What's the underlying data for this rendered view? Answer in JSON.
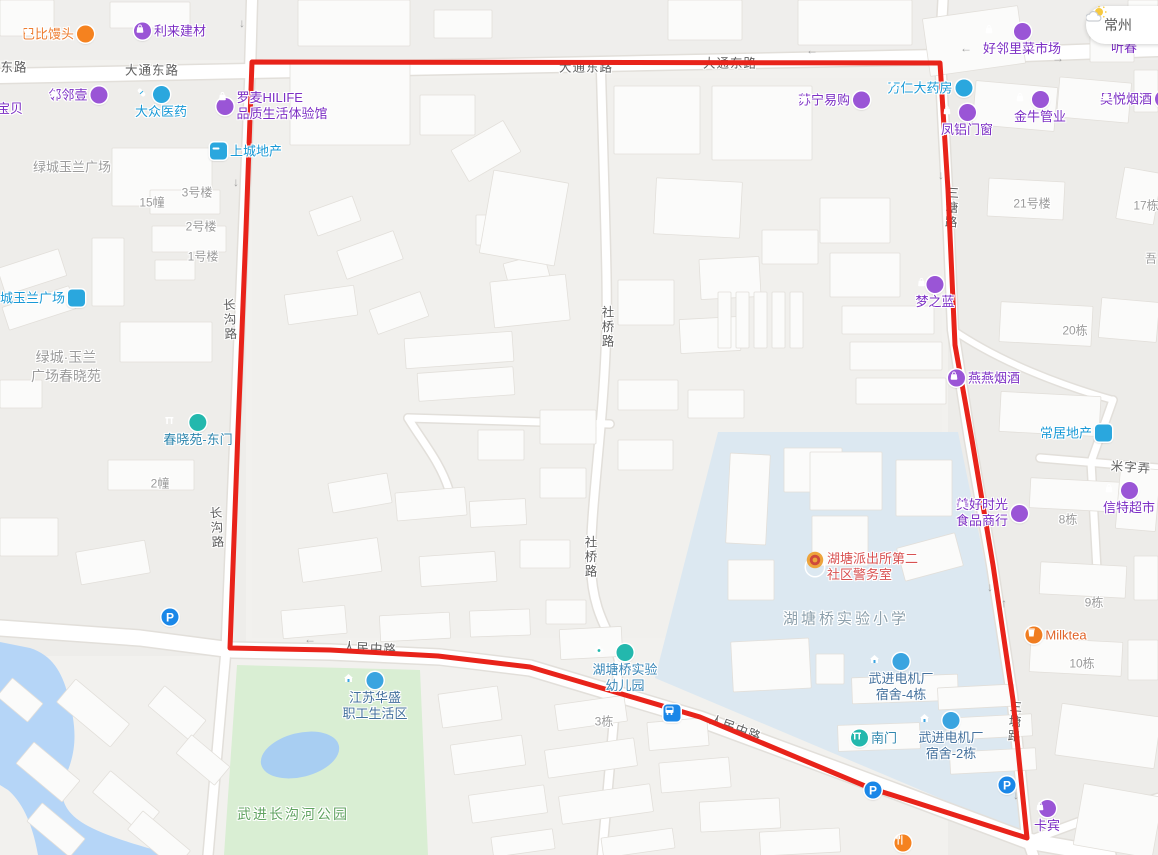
{
  "app": {
    "title": "地图"
  },
  "weather": {
    "city": "常州"
  },
  "colors": {
    "route_red": "#e8231a",
    "poi_purple_text": "#7c2fc4",
    "poi_purple_icon": "#9a55d6",
    "poi_blue_text": "#1899d6",
    "poi_blue_icon": "#2aa7de",
    "teal_icon": "#23b8ad",
    "gate_text": "#2e86ad",
    "residence_text": "#44719d",
    "residence_icon": "#3aa4e0",
    "police_text": "#d85151",
    "badge_gold": "#eda43c",
    "badge_red": "#cf4a3c",
    "orange_icon": "#f5821f",
    "orange_text": "#ed7d31",
    "milktea_text": "#e0642a",
    "parking_blue": "#1a87e8",
    "road_label": "#5e5e5e",
    "building_label": "#9b9b9b",
    "park_fill": "#d9eed3",
    "water_fill": "#b5d5f7",
    "campus_fill": "#dce8f1"
  },
  "types": {
    "shop": {
      "icon": "bag",
      "iconBg": "#9a55d6",
      "text": "#7c2fc4"
    },
    "pharmacy": {
      "icon": "capsule",
      "iconBg": "#2aa7de",
      "text": "#1899d6"
    },
    "estate": {
      "icon": "dash",
      "iconBg": "#2aa7de",
      "text": "#1899d6",
      "square": true
    },
    "gate": {
      "icon": "gate",
      "iconBg": "#23b8ad",
      "text": "#2e86ad"
    },
    "kindergarten": {
      "icon": "flower",
      "iconBg": "#23b8ad",
      "text": "#3a87b7"
    },
    "residence": {
      "icon": "house",
      "iconBg": "#3aa4e0",
      "text": "#44719d"
    },
    "police": {
      "icon": "badge",
      "iconBg": "#eda43c",
      "text": "#d85151"
    },
    "bun": {
      "icon": "hand",
      "iconBg": "#f5821f",
      "text": "#ed7d31"
    },
    "milktea": {
      "icon": "cup",
      "iconBg": "#f07d21",
      "text": "#e0642a"
    },
    "parking": {
      "icon": "P",
      "iconBg": "#1a87e8",
      "text": "#1a87e8"
    },
    "bus": {
      "icon": "bus",
      "iconBg": "#1a87e8",
      "text": "#1a87e8",
      "square": true
    },
    "restaurant": {
      "icon": "fork",
      "iconBg": "#f5821f",
      "text": "#f5821f"
    },
    "text-purple": {
      "icon": "",
      "iconBg": "",
      "text": "#7c2fc4"
    }
  },
  "pois": [
    {
      "name": "babi-mantou",
      "type": "bun",
      "layout": "row-rev",
      "x": 58,
      "y": 34,
      "lines": [
        "巴比馒头"
      ]
    },
    {
      "name": "lilai-jiancai",
      "type": "shop",
      "layout": "row",
      "x": 170,
      "y": 31,
      "lines": [
        "利来建材"
      ]
    },
    {
      "name": "linlinyi",
      "type": "shop",
      "layout": "row-rev",
      "x": 78,
      "y": 95,
      "lines": [
        "邻邻壹"
      ]
    },
    {
      "name": "baobei",
      "type": "text-purple",
      "layout": "text",
      "x": 10,
      "y": 109,
      "lines": [
        "宝贝"
      ]
    },
    {
      "name": "dazhong-pharmacy",
      "type": "pharmacy",
      "layout": "col",
      "x": 161,
      "y": 103,
      "lines": [
        "大众医药"
      ]
    },
    {
      "name": "luomai-hilife",
      "type": "shop",
      "layout": "row",
      "x": 272,
      "y": 106,
      "lines": [
        "罗麦HILIFE",
        "品质生活体验馆"
      ]
    },
    {
      "name": "shangcheng-estate",
      "type": "estate",
      "layout": "row",
      "x": 246,
      "y": 151,
      "lines": [
        "上城地产"
      ]
    },
    {
      "name": "lvcheng-yulan-plaza",
      "type": "estate",
      "layout": "row-rev",
      "x": 36,
      "y": 298,
      "lines": [
        "绿城玉兰广场"
      ]
    },
    {
      "name": "chunxiao-east-gate",
      "type": "gate",
      "layout": "col",
      "x": 198,
      "y": 431,
      "lines": [
        "春晓苑-东门"
      ]
    },
    {
      "name": "haolinli-market",
      "type": "shop",
      "layout": "col",
      "x": 1022,
      "y": 40,
      "lines": [
        "好邻里菜市场"
      ]
    },
    {
      "name": "suning-store",
      "type": "shop",
      "layout": "row-rev",
      "x": 834,
      "y": 100,
      "lines": [
        "苏宁易购"
      ]
    },
    {
      "name": "wanren-pharmacy",
      "type": "pharmacy",
      "layout": "row-rev",
      "x": 930,
      "y": 88,
      "lines": [
        "万仁大药房"
      ]
    },
    {
      "name": "fenglv-windows",
      "type": "shop",
      "layout": "col",
      "x": 967,
      "y": 121,
      "lines": [
        "凤铝门窗"
      ]
    },
    {
      "name": "jinniu-pipes",
      "type": "shop",
      "layout": "col",
      "x": 1040,
      "y": 108,
      "lines": [
        "金牛管业"
      ]
    },
    {
      "name": "wuyue-tobacco",
      "type": "shop",
      "layout": "row-rev",
      "x": 1136,
      "y": 99,
      "lines": [
        "吴悦烟酒"
      ]
    },
    {
      "name": "mengzhilan",
      "type": "shop",
      "layout": "col",
      "x": 935,
      "y": 293,
      "lines": [
        "梦之蓝"
      ]
    },
    {
      "name": "yanyan-tobacco",
      "type": "shop",
      "layout": "row",
      "x": 984,
      "y": 378,
      "lines": [
        "燕燕烟酒"
      ]
    },
    {
      "name": "changju-estate",
      "type": "estate",
      "layout": "row-rev",
      "x": 1076,
      "y": 433,
      "lines": [
        "常居地产"
      ]
    },
    {
      "name": "meihao-shiguang",
      "type": "shop",
      "layout": "row-rev",
      "x": 992,
      "y": 513,
      "lines": [
        "美好时光",
        "食品商行"
      ]
    },
    {
      "name": "xinte-supermarket",
      "type": "shop",
      "layout": "col",
      "x": 1129,
      "y": 499,
      "lines": [
        "信特超市"
      ]
    },
    {
      "name": "milktea-shop",
      "type": "milktea",
      "layout": "row",
      "x": 1056,
      "y": 635,
      "lines": [
        "Milktea"
      ]
    },
    {
      "name": "police-station-room",
      "type": "police",
      "layout": "row",
      "x": 862,
      "y": 567,
      "lines": [
        "湖塘派出所第二",
        "社区警务室"
      ]
    },
    {
      "name": "experimental-kindergarten",
      "type": "kindergarten",
      "layout": "col",
      "x": 625,
      "y": 669,
      "lines": [
        "湖塘桥实验",
        "幼儿园"
      ]
    },
    {
      "name": "jiangsu-huasheng",
      "type": "residence",
      "layout": "col",
      "x": 375,
      "y": 697,
      "lines": [
        "江苏华盛",
        "职工生活区"
      ]
    },
    {
      "name": "motor-dorm-4",
      "type": "residence",
      "layout": "col",
      "x": 901,
      "y": 678,
      "lines": [
        "武进电机厂",
        "宿舍-4栋"
      ]
    },
    {
      "name": "south-gate",
      "type": "gate",
      "layout": "row",
      "x": 874,
      "y": 738,
      "lines": [
        "南门"
      ]
    },
    {
      "name": "motor-dorm-2",
      "type": "residence",
      "layout": "col",
      "x": 951,
      "y": 737,
      "lines": [
        "武进电机厂",
        "宿舍-2栋"
      ]
    },
    {
      "name": "kabin",
      "type": "shop",
      "layout": "col",
      "x": 1047,
      "y": 817,
      "lines": [
        "卡宾"
      ]
    },
    {
      "name": "tingchun",
      "type": "text-purple",
      "layout": "text",
      "x": 1124,
      "y": 48,
      "lines": [
        "听春"
      ]
    },
    {
      "name": "parking-west",
      "type": "parking",
      "layout": "icon",
      "x": 170,
      "y": 617,
      "lines": []
    },
    {
      "name": "parking-south",
      "type": "parking",
      "layout": "icon",
      "x": 873,
      "y": 790,
      "lines": []
    },
    {
      "name": "parking-east",
      "type": "parking",
      "layout": "icon",
      "x": 1007,
      "y": 785,
      "lines": []
    },
    {
      "name": "bus-stop",
      "type": "bus",
      "layout": "icon",
      "x": 672,
      "y": 713,
      "lines": []
    },
    {
      "name": "restaurant-poi",
      "type": "restaurant",
      "layout": "icon",
      "x": 903,
      "y": 843,
      "lines": []
    }
  ],
  "road_labels": [
    {
      "text": "东路",
      "x": 14,
      "y": 66
    },
    {
      "text": "大通东路",
      "x": 152,
      "y": 69
    },
    {
      "text": "大通东路",
      "x": 586,
      "y": 66
    },
    {
      "text": "大通东路",
      "x": 730,
      "y": 62
    },
    {
      "text": "人民中路",
      "x": 370,
      "y": 647,
      "rot": 3
    },
    {
      "text": "人民中路",
      "x": 736,
      "y": 727,
      "rot": 20
    },
    {
      "text": "米字弄",
      "x": 1131,
      "y": 466,
      "rot": 4
    },
    {
      "text": "社桥路",
      "x": 607,
      "y": 327,
      "v": true
    },
    {
      "text": "社桥路",
      "x": 590,
      "y": 557,
      "v": true
    },
    {
      "text": "长沟路",
      "x": 229,
      "y": 320,
      "v": true,
      "rot": -3
    },
    {
      "text": "长沟路",
      "x": 216,
      "y": 528,
      "v": true,
      "rot": -4
    },
    {
      "text": "三塘路",
      "x": 951,
      "y": 208,
      "v": true,
      "rot": 3
    },
    {
      "text": "三塘路",
      "x": 1014,
      "y": 722,
      "v": true,
      "rot": 4
    }
  ],
  "building_labels": [
    {
      "text": "15幢",
      "x": 152,
      "y": 202
    },
    {
      "text": "3号楼",
      "x": 197,
      "y": 192
    },
    {
      "text": "2号楼",
      "x": 201,
      "y": 226
    },
    {
      "text": "1号楼",
      "x": 203,
      "y": 256
    },
    {
      "text": "2幢",
      "x": 160,
      "y": 483
    },
    {
      "text": "21号楼",
      "x": 1032,
      "y": 203
    },
    {
      "text": "17栋",
      "x": 1146,
      "y": 205
    },
    {
      "text": "吾",
      "x": 1151,
      "y": 258
    },
    {
      "text": "20栋",
      "x": 1075,
      "y": 330
    },
    {
      "text": "8栋",
      "x": 1068,
      "y": 519
    },
    {
      "text": "9栋",
      "x": 1094,
      "y": 602
    },
    {
      "text": "10栋",
      "x": 1082,
      "y": 663
    },
    {
      "text": "3栋",
      "x": 604,
      "y": 721
    }
  ],
  "area_labels": [
    {
      "text": "绿城玉兰广场",
      "x": 72,
      "y": 166,
      "cls": "gray",
      "size": 13
    },
    {
      "text": "绿城·玉兰",
      "x": 66,
      "y": 357,
      "cls": "gray",
      "size": 14
    },
    {
      "text": "广场春晓苑",
      "x": 66,
      "y": 376,
      "cls": "gray",
      "size": 14
    },
    {
      "text": "湖塘桥实验小学",
      "x": 846,
      "y": 618,
      "cls": "campus",
      "size": 15
    },
    {
      "text": "武进长沟河公园",
      "x": 293,
      "y": 814,
      "cls": "park",
      "size": 14
    }
  ]
}
